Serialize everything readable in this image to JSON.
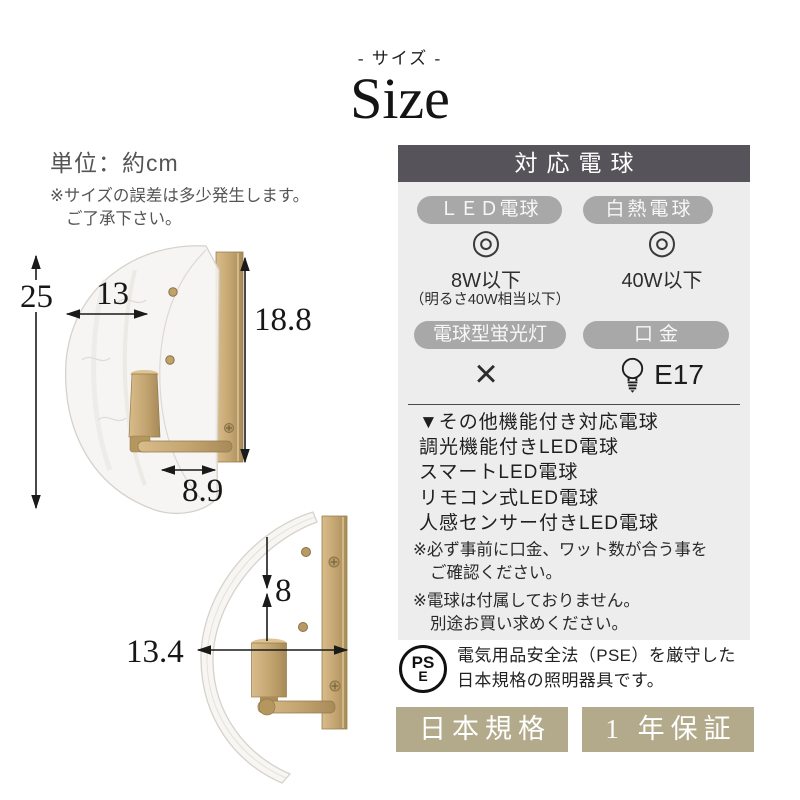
{
  "page": {
    "subtitle": "- サイズ -",
    "title": "Size"
  },
  "size_info": {
    "unit": "単位：約cm",
    "disclaimer_line1": "※サイズの誤差は多少発生します。",
    "disclaimer_line2": "ご了承下さい。",
    "front_view": {
      "total_height_cm": "25",
      "shade_width_cm": "13",
      "plate_height_cm": "18.8",
      "base_width_cm": "8.9"
    },
    "side_view": {
      "socket_drop_cm": "8",
      "total_depth_cm": "13.4"
    }
  },
  "bulb_panel": {
    "title": "対応電球",
    "led": {
      "label": "ＬＥＤ電球",
      "mark": "◎",
      "value": "8W以下",
      "value_note": "（明るさ40W相当以下）"
    },
    "incandescent": {
      "label": "白熱電球",
      "mark": "◎",
      "value": "40W以下"
    },
    "fluorescent": {
      "label": "電球型蛍光灯",
      "mark": "×"
    },
    "socket": {
      "label": "口金",
      "value": "E17"
    },
    "other_bulbs": {
      "heading": "▼その他機能付き対応電球",
      "items": [
        "調光機能付きLED電球",
        "スマートLED電球",
        "リモコン式LED電球",
        "人感センサー付きLED電球"
      ]
    },
    "notes": [
      {
        "line1": "※必ず事前に口金、ワット数が合う事を",
        "line2": "ご確認ください。"
      },
      {
        "line1": "※電球は付属しておりません。",
        "line2": "別途お買い求めください。"
      }
    ]
  },
  "pse": {
    "mark_top": "PS",
    "mark_bottom": "E",
    "line1": "電気用品安全法（PSE）を厳守した",
    "line2": "日本規格の照明器具です。"
  },
  "badges": {
    "standard": "日本規格",
    "warranty": "1 年保証"
  },
  "colors": {
    "panel_header": "#56545a",
    "pill": "#a8a8a8",
    "panel_bg": "#ededed",
    "badge": "#b2aa8a",
    "brass": "#c2a470"
  }
}
